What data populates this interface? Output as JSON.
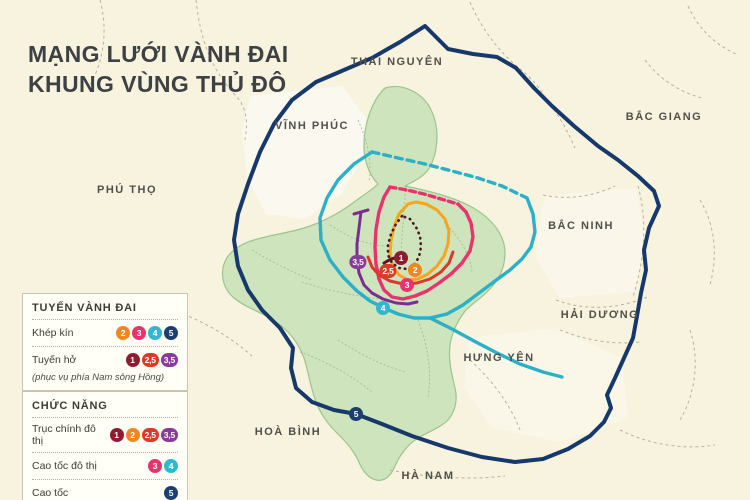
{
  "title": {
    "line1": "MẠNG LƯỚI VÀNH ĐAI",
    "line2": "KHUNG VÙNG THỦ ĐÔ"
  },
  "map": {
    "labels": [
      {
        "text": "THÁI NGUYÊN"
      },
      {
        "text": "VĨNH PHÚC"
      },
      {
        "text": "PHÚ THỌ"
      },
      {
        "text": "BẮC GIANG"
      },
      {
        "text": "BẮC NINH"
      },
      {
        "text": "HẢI DƯƠNG"
      },
      {
        "text": "HƯNG YÊN"
      },
      {
        "text": "HOÀ BÌNH"
      },
      {
        "text": "HÀ NAM"
      }
    ],
    "badges": [
      {
        "label": "1",
        "color": "#8c1c30"
      },
      {
        "label": "2",
        "color": "#f0861f"
      },
      {
        "label": "2,5",
        "color": "#da3a27"
      },
      {
        "label": "3",
        "color": "#e8336e"
      },
      {
        "label": "3,5",
        "color": "#8a3a99"
      },
      {
        "label": "4",
        "color": "#33b6ce"
      },
      {
        "label": "5",
        "color": "#1c3e71"
      }
    ]
  },
  "legend": {
    "box1": {
      "title": "TUYẾN VÀNH ĐAI",
      "rows": [
        {
          "label": "Khép kín",
          "badges": [
            {
              "label": "2",
              "color": "#f0861f"
            },
            {
              "label": "3",
              "color": "#e8336e"
            },
            {
              "label": "4",
              "color": "#33b6ce"
            },
            {
              "label": "5",
              "color": "#1c3e71"
            }
          ]
        },
        {
          "label": "Tuyến hở",
          "badges": [
            {
              "label": "1",
              "color": "#8c1c30"
            },
            {
              "label": "2,5",
              "color": "#da3a27"
            },
            {
              "label": "3,5",
              "color": "#8a3a99"
            }
          ]
        }
      ],
      "note": "(phục vụ phía Nam sông Hồng)"
    },
    "box2": {
      "title": "CHỨC NĂNG",
      "rows": [
        {
          "label": "Trục chính đô thị",
          "badges": [
            {
              "label": "1",
              "color": "#8c1c30"
            },
            {
              "label": "2",
              "color": "#f0861f"
            },
            {
              "label": "2,5",
              "color": "#da3a27"
            },
            {
              "label": "3,5",
              "color": "#8a3a99"
            }
          ]
        },
        {
          "label": "Cao tốc đô thị",
          "badges": [
            {
              "label": "3",
              "color": "#e8336e"
            },
            {
              "label": "4",
              "color": "#33b6ce"
            }
          ]
        },
        {
          "label": "Cao tốc",
          "badges": [
            {
              "label": "5",
              "color": "#1c3e71"
            }
          ]
        }
      ]
    }
  },
  "colors": {
    "background": "#f7f3de",
    "hanoi_region": "#cde4bc",
    "region_border": "#9cc48e",
    "province_border": "#b9b29c",
    "district_border": "#a3bf95",
    "label_text": "#50504a",
    "title_text": "#3d4144",
    "ring1_dotted": "#4a1620",
    "ring1_solid": "#5a1426",
    "ring2": "#f6a51f",
    "ring2_5": "#da3a27",
    "ring3": "#e8336e",
    "ring3_5": "#7c2e90",
    "ring4": "#2cb0c8",
    "ring5": "#16386b"
  }
}
